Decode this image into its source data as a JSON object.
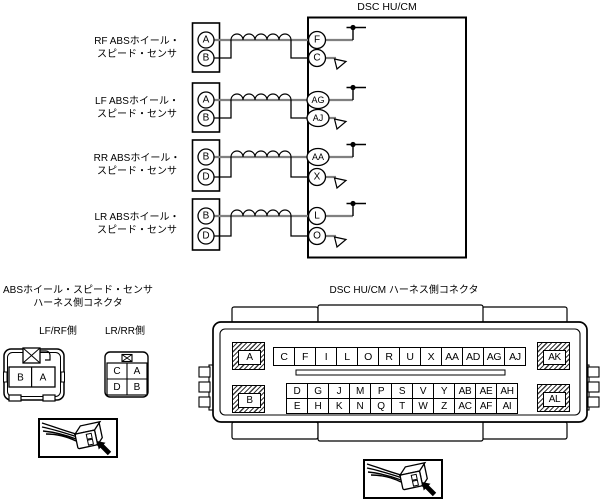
{
  "wiring": {
    "hu_title": "DSC HU/CM",
    "rows": [
      {
        "label1": "RF ABSホイール・",
        "label2": "スピード・センサ",
        "sensor_top": "A",
        "sensor_bottom": "B",
        "hu_top": "F",
        "hu_bottom": "C"
      },
      {
        "label1": "LF ABSホイール・",
        "label2": "スピード・センサ",
        "sensor_top": "A",
        "sensor_bottom": "B",
        "hu_top": "AG",
        "hu_bottom": "AJ"
      },
      {
        "label1": "RR ABSホイール・",
        "label2": "スピード・センサ",
        "sensor_top": "B",
        "sensor_bottom": "D",
        "hu_top": "AA",
        "hu_bottom": "X"
      },
      {
        "label1": "LR ABSホイール・",
        "label2": "スピード・センサ",
        "sensor_top": "B",
        "sensor_bottom": "D",
        "hu_top": "L",
        "hu_bottom": "O"
      }
    ]
  },
  "abs_side": {
    "title1": "ABSホイール・スピード・センサ",
    "title2": "ハーネス側コネクタ",
    "lfrf": {
      "label": "LF/RF側",
      "pin_left": "B",
      "pin_right": "A"
    },
    "lrrr": {
      "label": "LR/RR側",
      "r1c1": "C",
      "r1c2": "A",
      "r2c1": "D",
      "r2c2": "B"
    }
  },
  "hu_side": {
    "title": "DSC HU/CM ハーネス側コネクタ",
    "corner_a": "A",
    "corner_b": "B",
    "corner_ak": "AK",
    "corner_al": "AL",
    "row1": [
      "C",
      "F",
      "I",
      "L",
      "O",
      "R",
      "U",
      "X",
      "AA",
      "AD",
      "AG",
      "AJ"
    ],
    "row2": [
      "D",
      "G",
      "J",
      "M",
      "P",
      "S",
      "V",
      "Y",
      "AB",
      "AE",
      "AH"
    ],
    "row3": [
      "E",
      "H",
      "K",
      "N",
      "Q",
      "T",
      "W",
      "Z",
      "AC",
      "AF",
      "AI"
    ]
  },
  "colors": {
    "wire_gray": "#808080",
    "line_black": "#000000"
  }
}
